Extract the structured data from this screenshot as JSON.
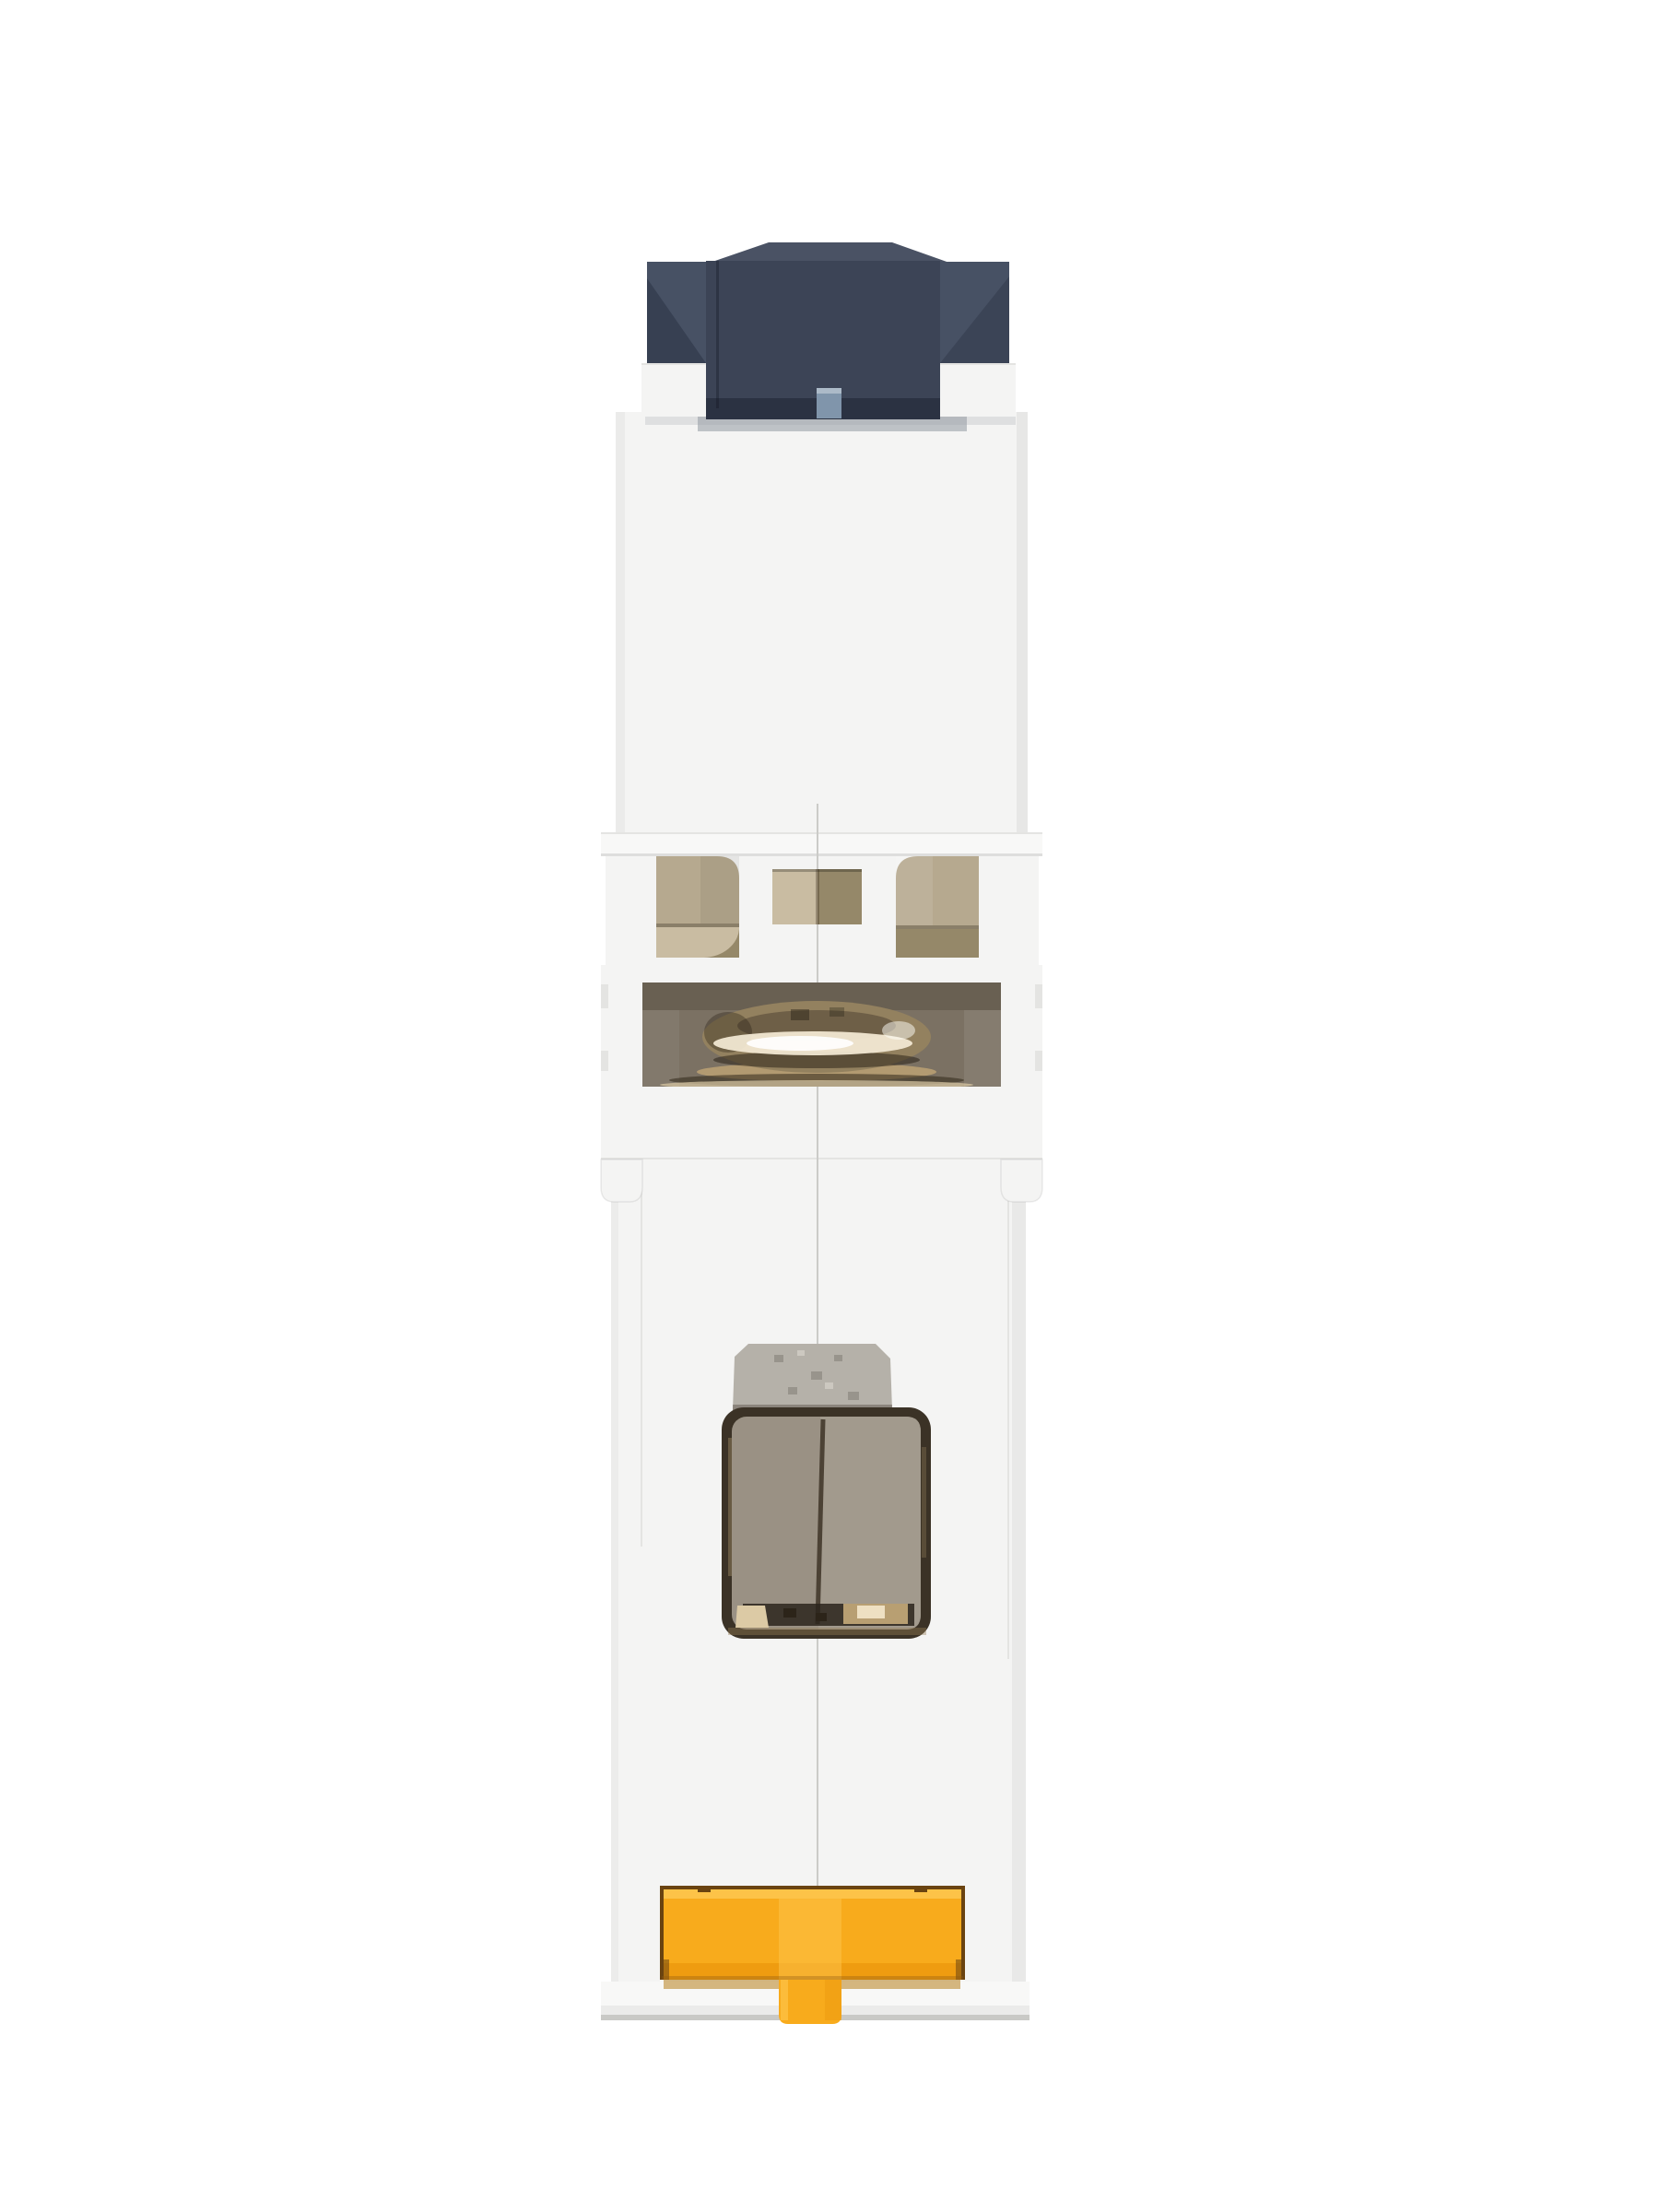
{
  "scene": {
    "description": "Side profile product photo of a single-pole miniature circuit breaker module on a white background: dark slate toggle actuator on top, white molded housing with vent windows, a metal wire-clamp terminal loop visible in an opening, a galvanized latch plate behind a dark inspection window, and a yellow DIN-rail release clip at the bottom."
  },
  "parts": {
    "toggle": "actuator toggle (dark slate, off position)",
    "upper_housing": "upper white housing block",
    "collar": "housing collar ledge",
    "vent_windows": "two beige vent windows and center slot",
    "terminal_cavity": "terminal cavity with metal clamp loop",
    "latch_plate": "galvanized steel latch plate",
    "inspection_window": "dark framed inspection window with taupe panels",
    "din_clip": "yellow DIN-rail release clip",
    "seam": "center mold seam line"
  },
  "colors": {
    "background": "#ffffff",
    "body": "#f4f4f3",
    "bodyHighlight": "#f8f8f7",
    "bodyLine": "#e4e4e2",
    "baseShadow": "#c9c9c6",
    "seam": "#cbcbc8",
    "toggleDark": "#3c4456",
    "toggleMid": "#475164",
    "toggleCap": "#4a5264",
    "toggleTab": "#8095ab",
    "toggleShadow": "#9aa0a8",
    "windowBeige": "#b6a98f",
    "windowBeigeLight": "#c9bca2",
    "windowBeigeDark": "#958869",
    "windowLedge": "#8a7f69",
    "cavityTaupe": "#7b7163",
    "cavityShadow": "#655c4e",
    "ringBronze": "#93815f",
    "ringDark": "#6e5f47",
    "ringHighlight": "#f1e7d2",
    "plateGray": "#b5b1a9",
    "plateSpeckle": "#918d85",
    "frameDark": "#3b3226",
    "panelLeft": "#9a9184",
    "panelRight": "#a29a8d",
    "panelDivider": "#4c4235",
    "glintBright": "#dccaa5",
    "glintWarm": "#b89f72",
    "clipYellow": "#f8ab1c",
    "clipYellowLight": "#fdc348",
    "clipYellowDeep": "#ef9c10",
    "clipOutline": "#6a4310",
    "clipShadow": "#b7801e"
  }
}
